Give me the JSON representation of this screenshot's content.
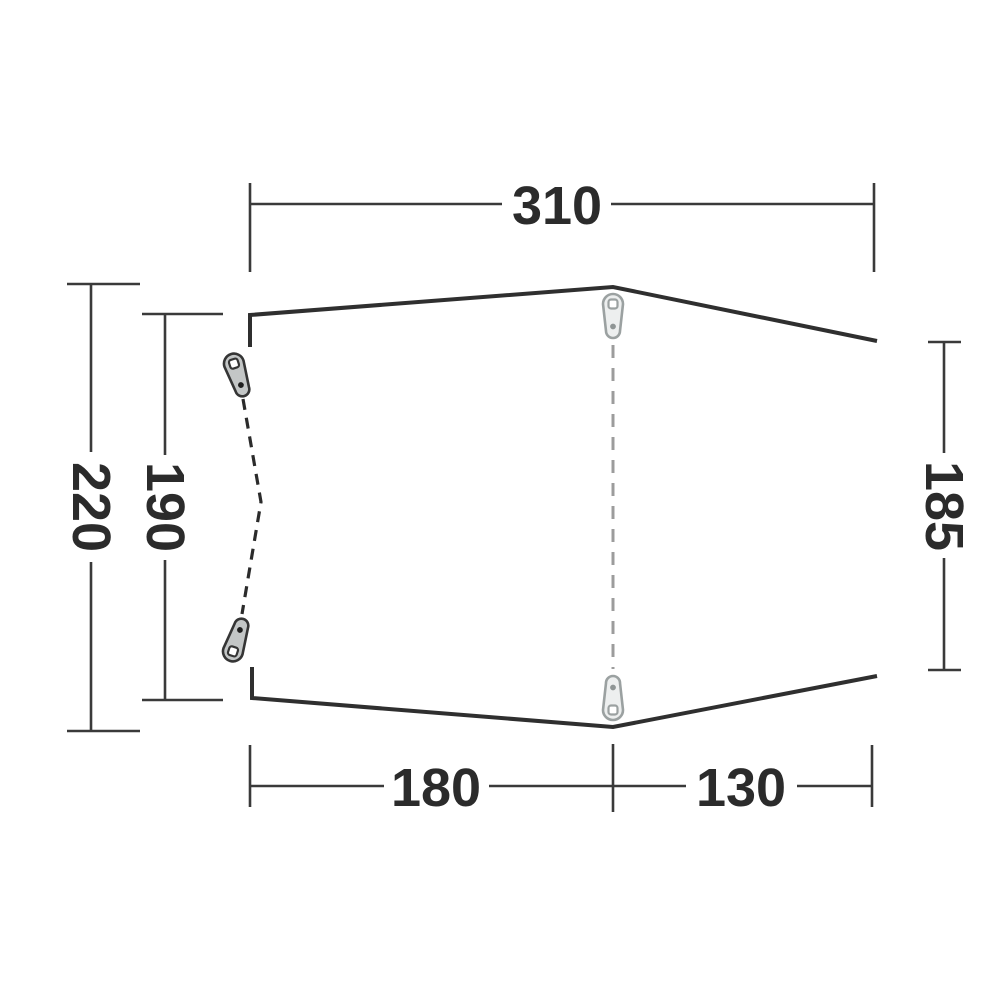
{
  "diagram": {
    "name": "tent-footprint-top-view-dimension-diagram",
    "background_color": "#ffffff",
    "outline_color": "#2f2f2f",
    "dimension_line_color": "#3a3a3a",
    "label_color": "#2b2b2b",
    "door_dash_color": "#2b2b2b",
    "seam_dash_color": "#9c9c9c",
    "peg_dark_colors": {
      "outline": "#353535",
      "fill": "#c3c6c6",
      "hole": "#ffffff",
      "dot": "#1f1f1f"
    },
    "peg_light_colors": {
      "outline": "#9ba1a1",
      "fill": "#edefef",
      "hole": "#ffffff",
      "dot": "#8f9595"
    },
    "icons": [
      "tent-peg-icon"
    ],
    "dimensions": {
      "top_width": "310",
      "outer_depth": "220",
      "door_depth": "190",
      "right_depth": "185",
      "bottom_front_width": "180",
      "bottom_rear_width": "130"
    }
  }
}
